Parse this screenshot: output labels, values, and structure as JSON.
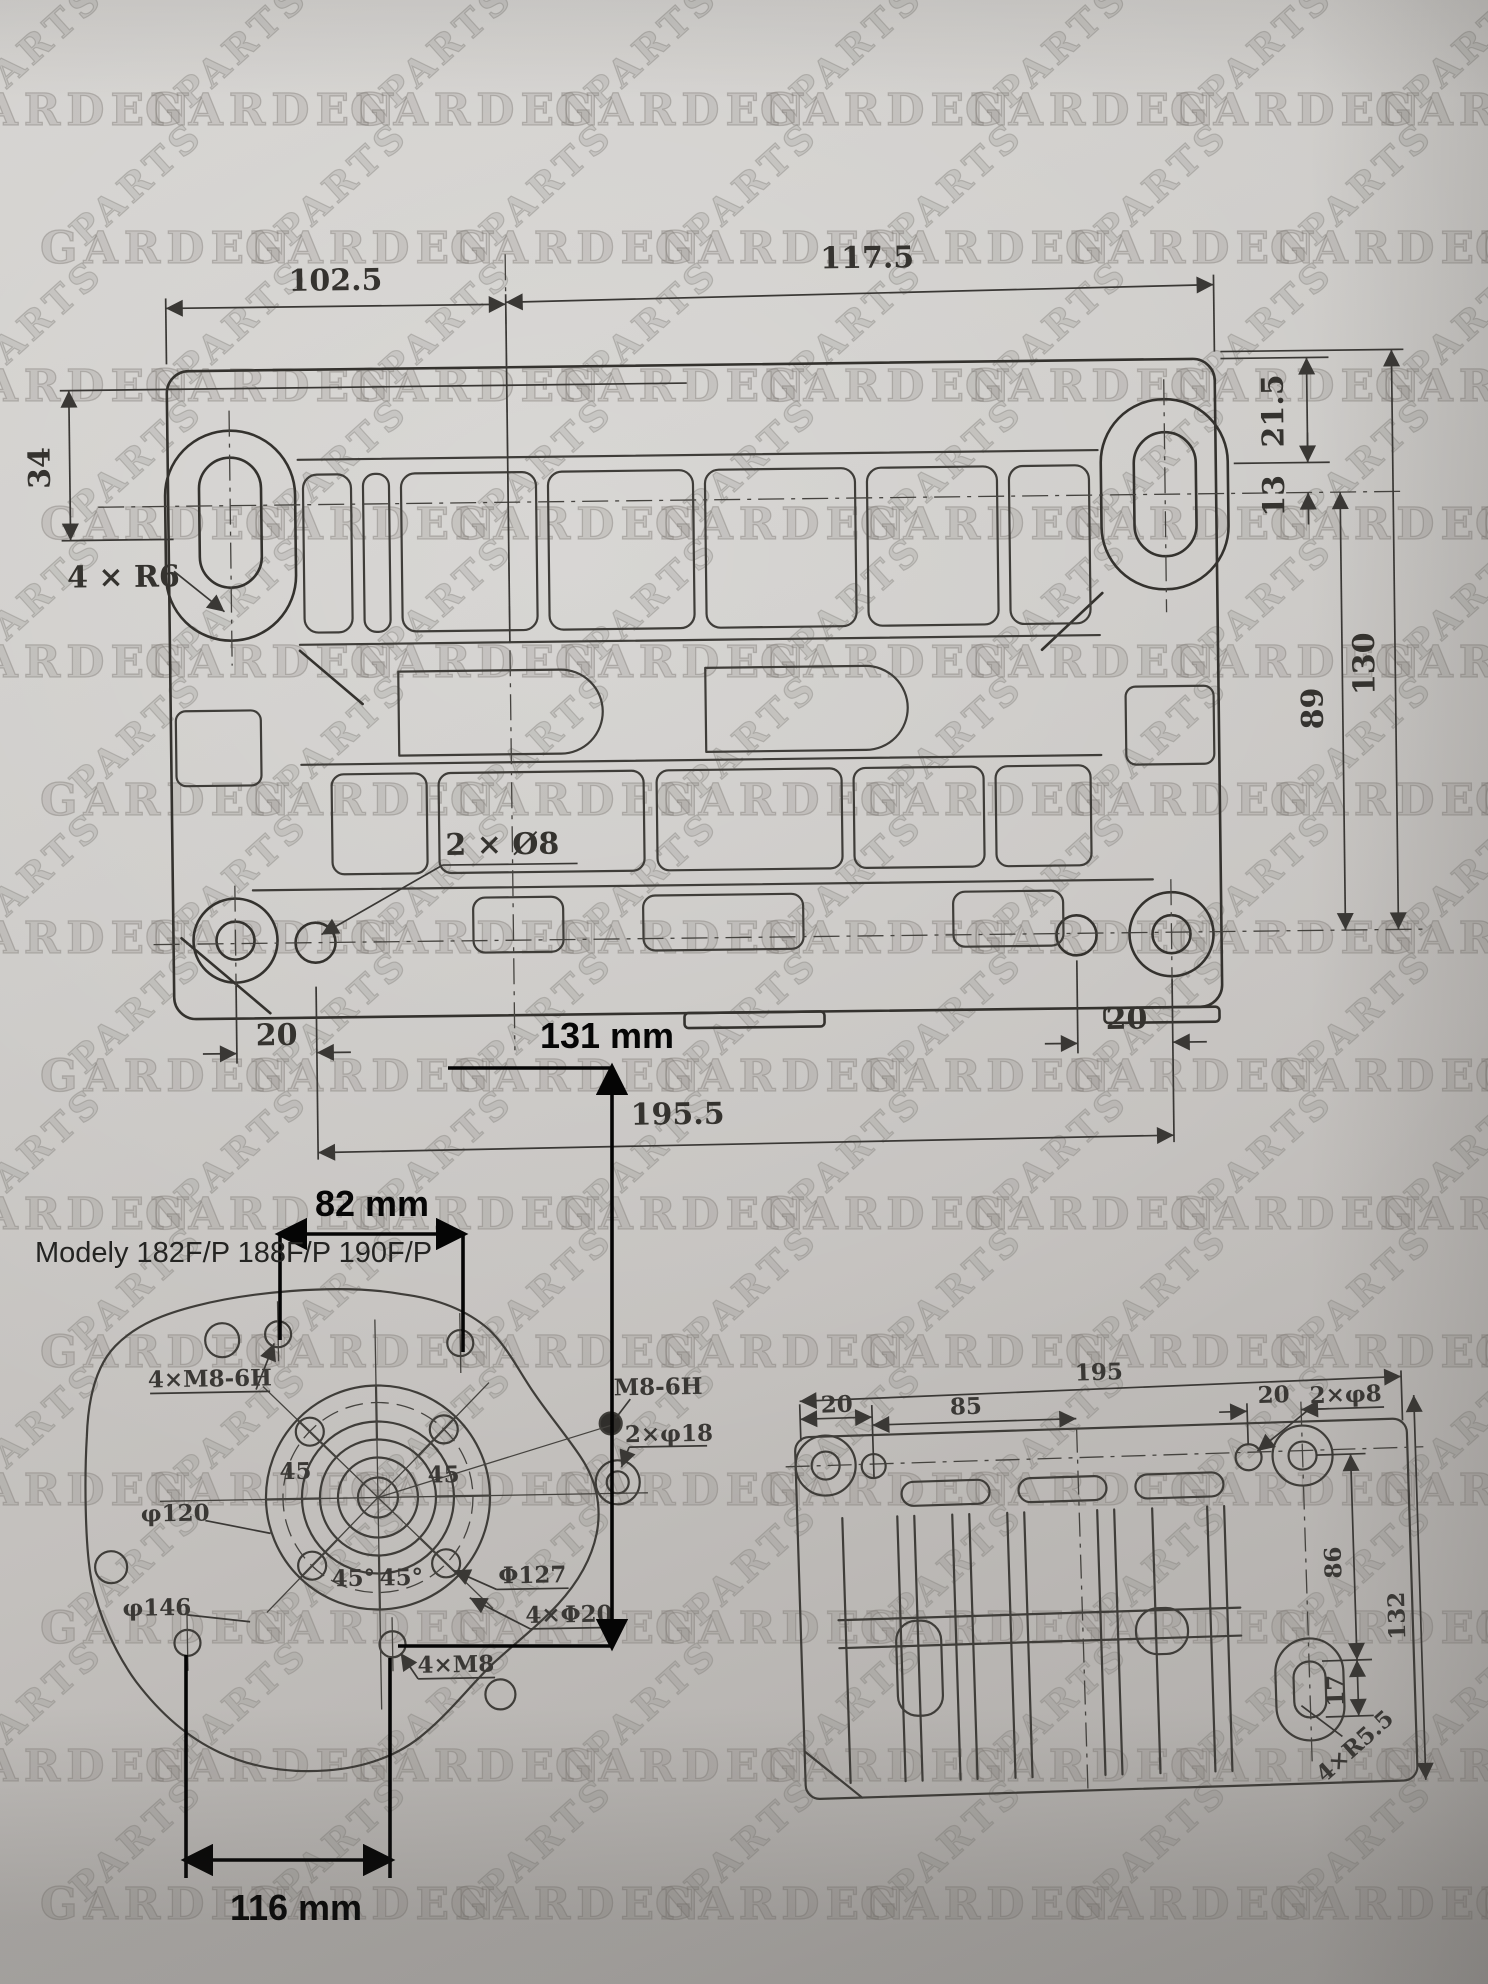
{
  "watermark": {
    "word_top": "PARTS",
    "word_main": "GARDEN"
  },
  "top_view": {
    "dim_top_left": "102.5",
    "dim_top_right": "117.5",
    "dim_right_offset": "21.5",
    "dim_right_small": "13",
    "dim_left": "34",
    "label_corner_radius": "4 × R6",
    "label_holes": "2 × Ø8",
    "dim_right_inner": "89",
    "dim_right_outer": "130",
    "dim_bottom_left": "20",
    "dim_bottom_right": "20",
    "dim_bottom": "195.5"
  },
  "overlay": {
    "models_line": "Modely 182F/P 188F/P 190F/P",
    "dim_top_width": "82 mm",
    "dim_height": "131 mm",
    "dim_bottom_width": "116 mm"
  },
  "crankcase_view": {
    "label_bolts_top": "4×M8-6H",
    "label_thread": "M8-6H",
    "label_dowels": "2×φ18",
    "label_d120": "φ120",
    "label_d146": "φ146",
    "label_d127": "Φ127",
    "label_d20": "4×Φ20",
    "label_m8": "4×M8",
    "angle_1": "45",
    "angle_2": "45",
    "angle_3": "45°",
    "angle_4": "45°"
  },
  "base_view": {
    "dim_20_left": "20",
    "dim_85": "85",
    "dim_195": "195",
    "dim_20_right": "20",
    "label_holes": "2×φ8",
    "dim_86": "86",
    "dim_132": "132",
    "dim_17": "17",
    "label_radius": "4×R5.5"
  }
}
